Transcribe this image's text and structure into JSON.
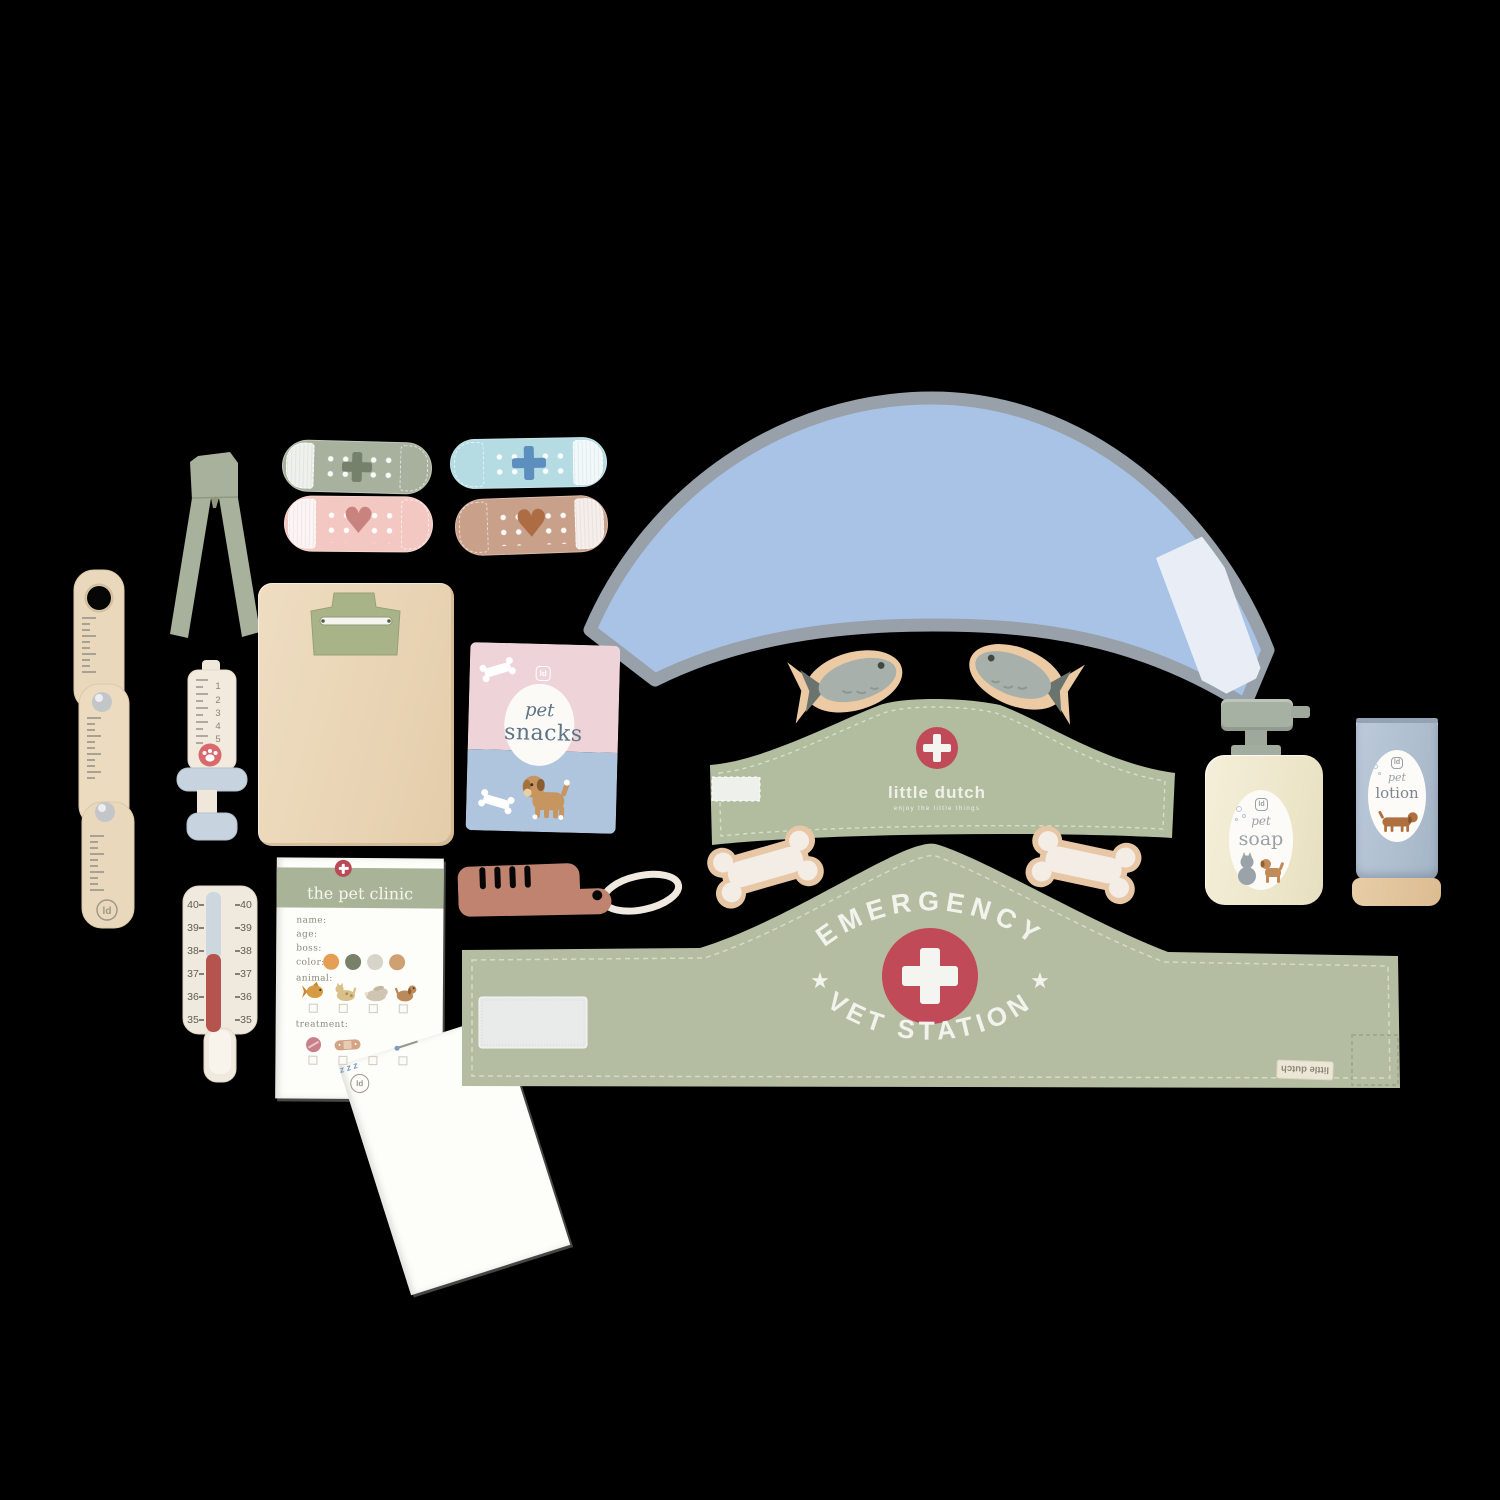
{
  "background": "#000000",
  "brand": "little dutch",
  "colors": {
    "felt_green": "#b4bda2",
    "cross_red": "#c04a57",
    "collar_blue": "#a9c3e6",
    "collar_trim": "#98a1aa",
    "wood": "#ead7ba",
    "snacks_pink": "#eed3d8",
    "snacks_blue": "#afc5dd",
    "thermometer_red": "#b5534f",
    "comb_terracotta": "#bf8370"
  },
  "texts": {
    "snacks": {
      "logo": "ld",
      "word1": "pet",
      "word2": "snacks"
    },
    "soap": {
      "logo": "ld",
      "word1": "pet",
      "word2": "soap"
    },
    "lotion": {
      "logo": "ld",
      "word1": "pet",
      "word2": "lotion"
    },
    "clinic": {
      "title": "the pet clinic",
      "field_name": "name:",
      "field_age": "age:",
      "field_boss": "boss:",
      "field_color": "color:",
      "field_animal": "animal:",
      "field_treatment": "treatment:",
      "logo": "ld",
      "zzz": "z z z"
    },
    "headband": {
      "brand": "little dutch",
      "tagline": "enjoy the little things"
    },
    "vetband": {
      "arc_top": "EMERGENCY",
      "arc_bottom": "VET STATION",
      "tag": "little dutch",
      "star": "★"
    },
    "ruler": {
      "logo": "ld"
    },
    "thermometer": {
      "scale": [
        "40",
        "39",
        "38",
        "37",
        "36",
        "35"
      ]
    },
    "syringe": {
      "scale": [
        "1",
        "2",
        "3",
        "4",
        "5"
      ]
    },
    "bandaids": {
      "heart": "♥"
    }
  }
}
